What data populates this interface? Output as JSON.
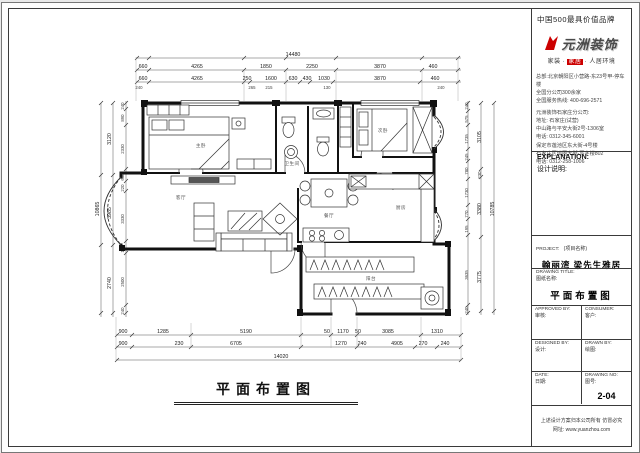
{
  "header": {
    "brand_slogan": "中国500最具价值品牌"
  },
  "logo": {
    "name": "元洲装饰",
    "tagline_left": "家装",
    "tagline_mid": "家居",
    "tagline_right": "人居环境",
    "accent_color": "#cc0000"
  },
  "contact": {
    "lines1": [
      "总部:北京朝阳区小营路-东23号甲-停车楼",
      "全国分公司300余家",
      "全国服务热线: 400-696-2571"
    ],
    "lines2": [
      "元洲装饰石家庄分公司:",
      "地址: 石家庄(试营)",
      "中山路与平安大街2号-1306室",
      "电话: 0312-345-6001",
      "保定市莲池区东大街-4号楼",
      "石家庄区谈固大街-写字楼802",
      "电话: 0312-258-1006"
    ]
  },
  "explanation": {
    "label": "EXPLANATION:",
    "sub": "设计说明:"
  },
  "project": {
    "label": "PROJECT:",
    "sub": "(项目名称)",
    "name": "翰丽湾 梁先生雅居"
  },
  "drawing_title": {
    "label": "DRAWING TITLE:",
    "sub": "图纸名称:",
    "value": "平面布置图"
  },
  "sign_table": {
    "approved_en": "APPROVED BY:",
    "approved_cn": "审核:",
    "consumer_en": "CONSUMER:",
    "consumer_cn": "客户:",
    "designed_en": "DESIGNED BY:",
    "designed_cn": "设计:",
    "drawn_en": "DRAWN BY:",
    "drawn_cn": "绘图:",
    "date_en": "DATE:",
    "date_cn": "日期:",
    "no_en": "DRAWING NO:",
    "no_cn": "图号:",
    "no_value": "2-04"
  },
  "footer": {
    "line1": "上述设计方案归本公司所有 仿冒必究",
    "line2": "网址: www.yuanzhou.com"
  },
  "plan": {
    "caption": "平面布置图",
    "rooms": [
      "主卧",
      "卫生间",
      "次卧",
      "客厅",
      "餐厅",
      "厨房",
      "阳台"
    ],
    "dims": {
      "top_total": "14480",
      "top_row1": [
        "660",
        "4265",
        "1850",
        "2250",
        "3870",
        "460"
      ],
      "top_row2": [
        "660",
        "4265",
        "250",
        "1600",
        "630",
        "430",
        "1030",
        "3870",
        "460"
      ],
      "top_row3": [
        "240",
        "265",
        "215",
        "130",
        "240"
      ],
      "bottom_total": "14020",
      "bottom_row1": [
        "900",
        "1285",
        "5190",
        "50",
        "1170",
        "50",
        "3085",
        "1310"
      ],
      "bottom_row2": [
        "900",
        "230",
        "6705",
        "1270",
        "240",
        "4905",
        "270",
        "240"
      ],
      "left_total": "10865",
      "left_outer": [
        "3120",
        "3985",
        "2740"
      ],
      "left_inner": [
        "240",
        "890",
        "2330",
        "660",
        "220",
        "3330",
        "145",
        "2500",
        "240"
      ],
      "right_total": "10785",
      "right_outer": [
        "3105",
        "230",
        "3380",
        "3775"
      ],
      "right_inner": [
        "240",
        "575",
        "1735",
        "245",
        "780",
        "1730",
        "770",
        "195",
        "3635",
        "240"
      ]
    }
  }
}
